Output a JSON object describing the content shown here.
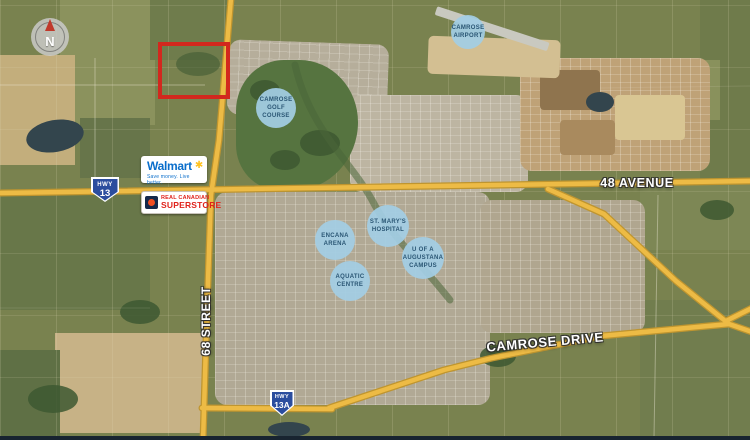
{
  "compass": {
    "label": "N"
  },
  "roads": {
    "avenue_48": "48 AVENUE",
    "camrose_drive": "CAMROSE DRIVE",
    "street_68": "68 STREET"
  },
  "shields": {
    "hwy13": {
      "prefix": "HWY",
      "number": "13"
    },
    "hwy13a": {
      "prefix": "HWY",
      "number": "13A"
    }
  },
  "pois": {
    "airport": {
      "lines": [
        "CAMROSE",
        "AIRPORT"
      ]
    },
    "golf": {
      "lines": [
        "CAMROSE",
        "GOLF",
        "COURSE"
      ]
    },
    "hospital": {
      "lines": [
        "ST. MARY'S",
        "HOSPITAL"
      ]
    },
    "arena": {
      "lines": [
        "ENCANA",
        "ARENA"
      ]
    },
    "university": {
      "lines": [
        "U OF A",
        "AUGUSTANA",
        "CAMPUS"
      ]
    },
    "aquatic": {
      "lines": [
        "AQUATIC",
        "CENTRE"
      ]
    }
  },
  "logos": {
    "walmart": {
      "name": "Walmart",
      "spark": "✱",
      "tagline": "Save money. Live better."
    },
    "superstore": {
      "line1": "REAL CANADIAN",
      "line2": "SUPERSTORE"
    }
  },
  "colors": {
    "road": "#edbb45",
    "road_casing": "#bf952f",
    "poi_circle": "#a3cde4",
    "poi_text": "#2a5674",
    "property_outline": "#d2281e",
    "shield_blue": "#2b4d9e",
    "walmart_blue": "#0a6ecb",
    "walmart_yellow": "#ffc220",
    "superstore_red": "#e0231c"
  }
}
